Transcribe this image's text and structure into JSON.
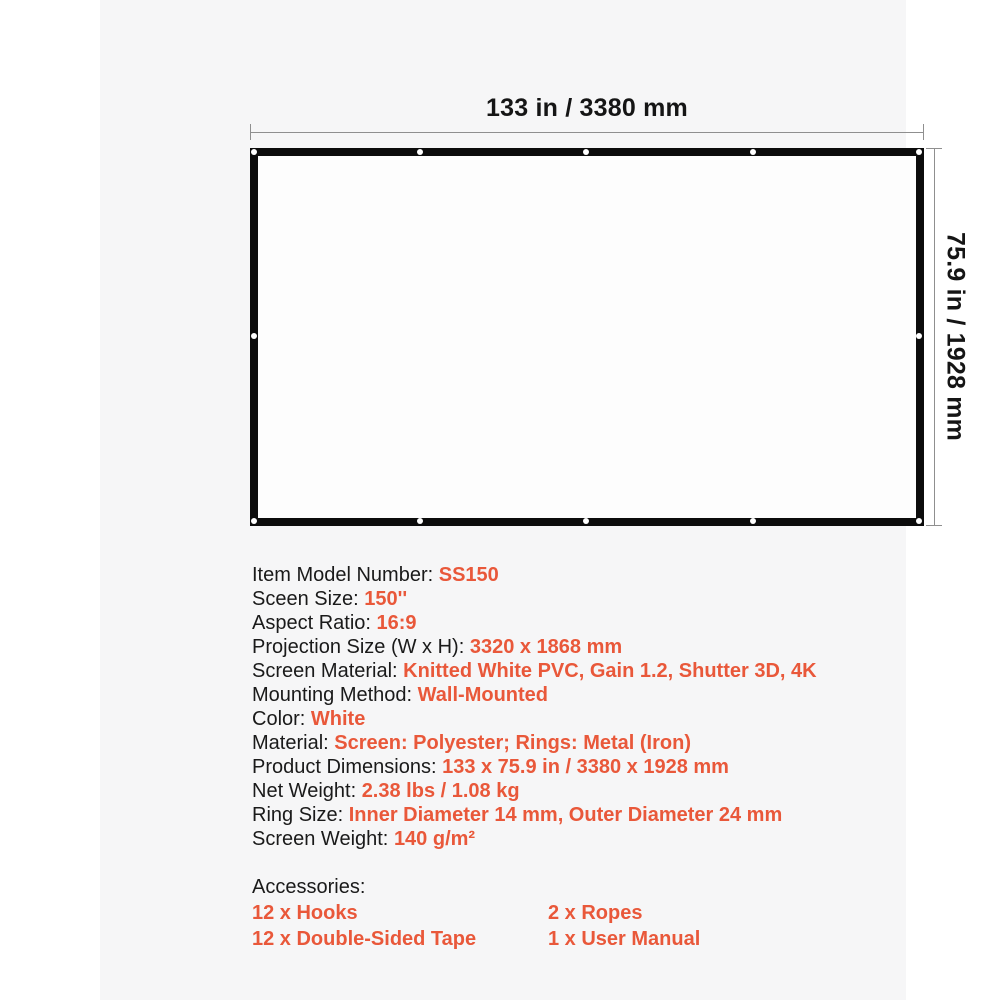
{
  "colors": {
    "accent_orange": "#e9583a",
    "text_black": "#1a1a1a",
    "panel_gray": "#f6f6f7",
    "frame_black": "#0c0c0c",
    "dimension_line_gray": "#8f8f8f"
  },
  "diagram": {
    "width_label": "133 in / 3380 mm",
    "height_label": "75.9 in / 1928 mm"
  },
  "specs": [
    {
      "label": "Item Model Number: ",
      "value": "SS150"
    },
    {
      "label": "Sceen Size: ",
      "value": "150''"
    },
    {
      "label": "Aspect Ratio: ",
      "value": "16:9"
    },
    {
      "label": "Projection Size (W x H): ",
      "value": "3320 x 1868 mm"
    },
    {
      "label": "Screen Material: ",
      "value": "Knitted White PVC, Gain 1.2, Shutter 3D, 4K"
    },
    {
      "label": "Mounting Method: ",
      "value": "Wall-Mounted"
    },
    {
      "label": "Color: ",
      "value": "White"
    },
    {
      "label": "Material: ",
      "value": "Screen: Polyester; Rings: Metal (Iron)"
    },
    {
      "label": "Product Dimensions: ",
      "value": "133 x 75.9 in / 3380 x 1928 mm"
    },
    {
      "label": "Net Weight: ",
      "value": "2.38 lbs / 1.08 kg"
    },
    {
      "label": "Ring Size: ",
      "value": "Inner Diameter 14 mm, Outer Diameter 24 mm"
    },
    {
      "label": "Screen Weight: ",
      "value": "140 g/m²"
    }
  ],
  "accessories": {
    "title": "Accessories:",
    "rows": [
      {
        "col1": "12 x Hooks",
        "col2": "2 x Ropes"
      },
      {
        "col1": "12 x Double-Sided Tape",
        "col2": "1 x User Manual"
      }
    ]
  }
}
